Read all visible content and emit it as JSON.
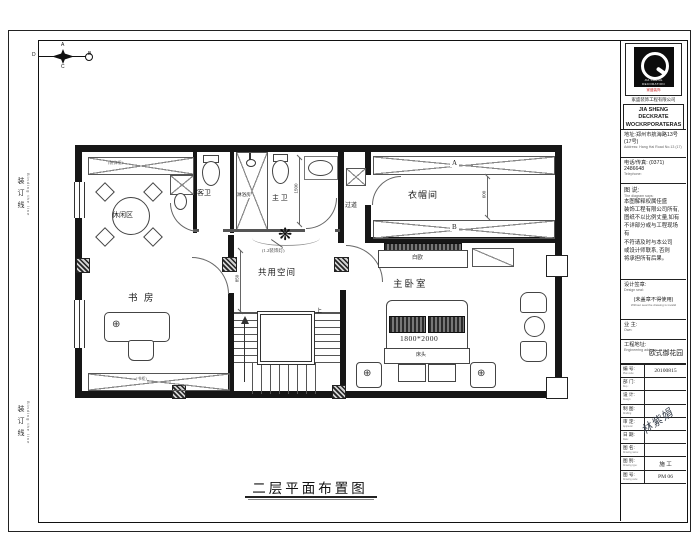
{
  "frame": {
    "binding_label": "装订线",
    "binding_label_en": "Binding the line"
  },
  "compass": {
    "n": "A",
    "e": "B",
    "s": "C",
    "w": "D"
  },
  "plan": {
    "title": "二层平面布置图",
    "rooms": {
      "leisure": "休闲区",
      "guest_bath": "客卫",
      "shower": "淋浴房",
      "master_bath": "主 卫",
      "corridor": "过道",
      "cloakroom": "衣帽间",
      "shared": "共用空间",
      "study": "书 房",
      "master_bedroom": "主卧室"
    },
    "annotations": {
      "top_cabinet": "(装饰柜)",
      "bookcase": "(书柜)",
      "ceiling_lamp": "(1.2装饰灯)",
      "tv_cabinet": "白欧",
      "headboard": "床头",
      "stairs_up": "上",
      "marker_a": "A",
      "marker_b": "B"
    },
    "dims": {
      "bed": "1800*2000",
      "wardrobe": "600",
      "bath": "1500",
      "stair": "850"
    }
  },
  "titleblock": {
    "logo_caption": "JIA SHENG DECORATION",
    "logo_sub_red": "家盛装饰",
    "company_cn": "家盛装饰工程有限公司",
    "company_en1": "JIA SHENG DECKRATE",
    "company_en2": "WOCKRPORATERAS",
    "address_cn": "地址:郑州市航海路13号(17号)",
    "address_en": "Address: Hang Hai Road No.13 (17)",
    "phone_cn": "电话/传真: (0371) 2486648",
    "phone_en": "Telephone:",
    "diagram_label": "图 说:",
    "diagram_label_en": "The diagram says:",
    "disclaimer": [
      "本图解释权属佳盛",
      "装饰工程有限公司所有,",
      "图纸不以比例丈量,如有",
      "不详部分或与工程现场有",
      "不符请及时与本公司",
      "或设计师联系, 否则",
      "将承担所有后果。"
    ],
    "seal_label": "设计签章:",
    "seal_label_en": "Design seal:",
    "seal_note": "(未盖章不得使用)",
    "seal_note_en": "Without seal the drawing is invalid",
    "owner_label": "业 主:",
    "owner_label_en": "Own:",
    "site_label": "工程地址:",
    "site_label_en": "Engineering address:",
    "site_value": "欧式御花园",
    "table": [
      {
        "label": "编 号:",
        "en": "Plan code:",
        "value": "20100815"
      },
      {
        "label": "部 门:",
        "en": "Dep.:",
        "value": ""
      },
      {
        "label": "设 计:",
        "en": "Design:",
        "value": ""
      },
      {
        "label": "制 图:",
        "en": "Drafting:",
        "value": ""
      },
      {
        "label": "审 定:",
        "en": "Approval:",
        "value": ""
      },
      {
        "label": "日 期:",
        "en": "Date:",
        "value": ""
      },
      {
        "label": "图 名:",
        "en": "Drawing name:",
        "value": ""
      },
      {
        "label": "图 别:",
        "en": "Drawing type:",
        "value": "施 工"
      },
      {
        "label": "图 号:",
        "en": "Drawing code:",
        "value": "PM 06"
      }
    ],
    "signature": "林紫娟"
  }
}
